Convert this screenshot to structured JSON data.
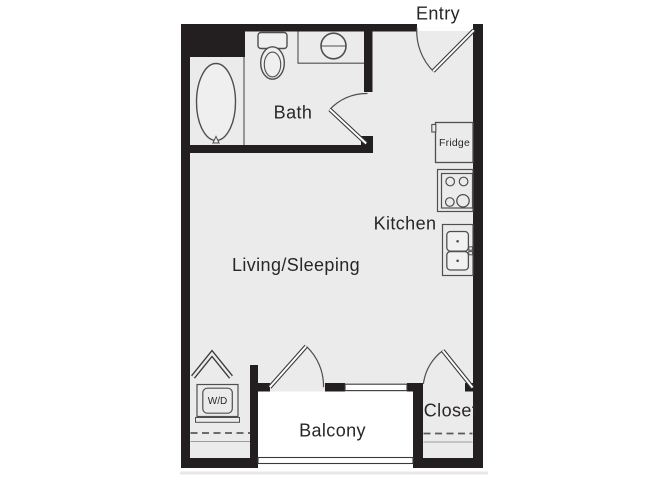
{
  "floorplan": {
    "rooms": {
      "entry": "Entry",
      "bath": "Bath",
      "kitchen": "Kitchen",
      "living": "Living/Sleeping",
      "balcony": "Balcony",
      "closet": "Closet"
    },
    "fixtures": {
      "fridge": "Fridge",
      "washer_dryer": "W/D"
    },
    "colors": {
      "wall": "#231f20",
      "floor": "#ebebeb",
      "fixture_fill": "#efefef",
      "balcony_floor": "#ffffff",
      "fixture_stroke": "#4f4f4f",
      "door_stroke": "#3a3a3a",
      "text": "#2a2627"
    }
  }
}
